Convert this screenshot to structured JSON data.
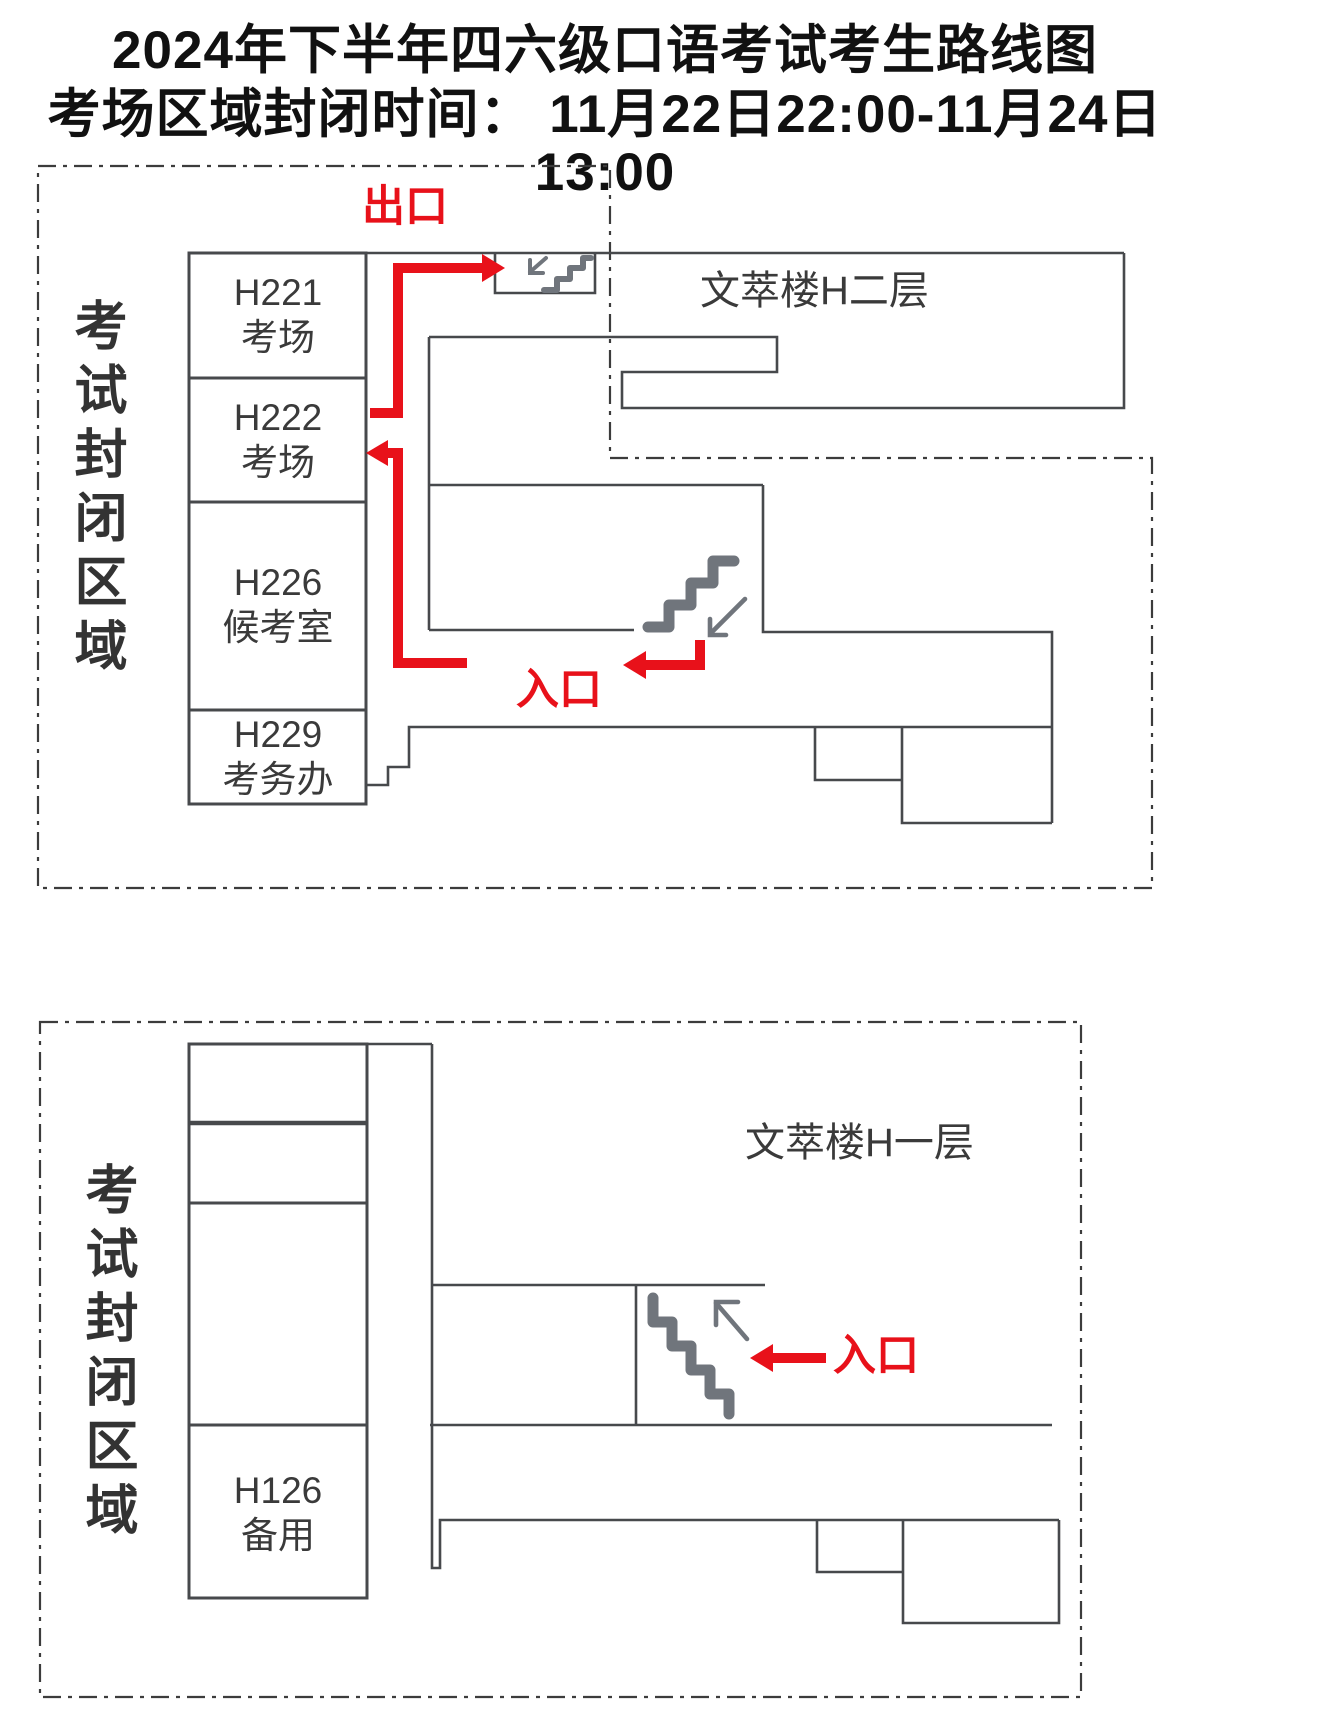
{
  "title": {
    "line1": "2024年下半年四六级口语考试考生路线图",
    "line2": "考场区域封闭时间： 11月22日22:00-11月24日13:00"
  },
  "floor2": {
    "zone_label": "考试封闭区域",
    "building_label": "文萃楼H二层",
    "exit_label": "出口",
    "entrance_label": "入口",
    "rooms": [
      {
        "id": "H221",
        "name": "考场"
      },
      {
        "id": "H222",
        "name": "考场"
      },
      {
        "id": "H226",
        "name": "候考室"
      },
      {
        "id": "H229",
        "name": "考务办"
      }
    ]
  },
  "floor1": {
    "zone_label": "考试封闭区域",
    "building_label": "文萃楼H一层",
    "entrance_label": "入口",
    "rooms": [
      {
        "id": "H126",
        "name": "备用"
      }
    ]
  },
  "colors": {
    "route_red": "#e8111a",
    "wall_gray": "#47494c",
    "stair_gray": "#70757c",
    "text_dark": "#3a3a3a"
  }
}
